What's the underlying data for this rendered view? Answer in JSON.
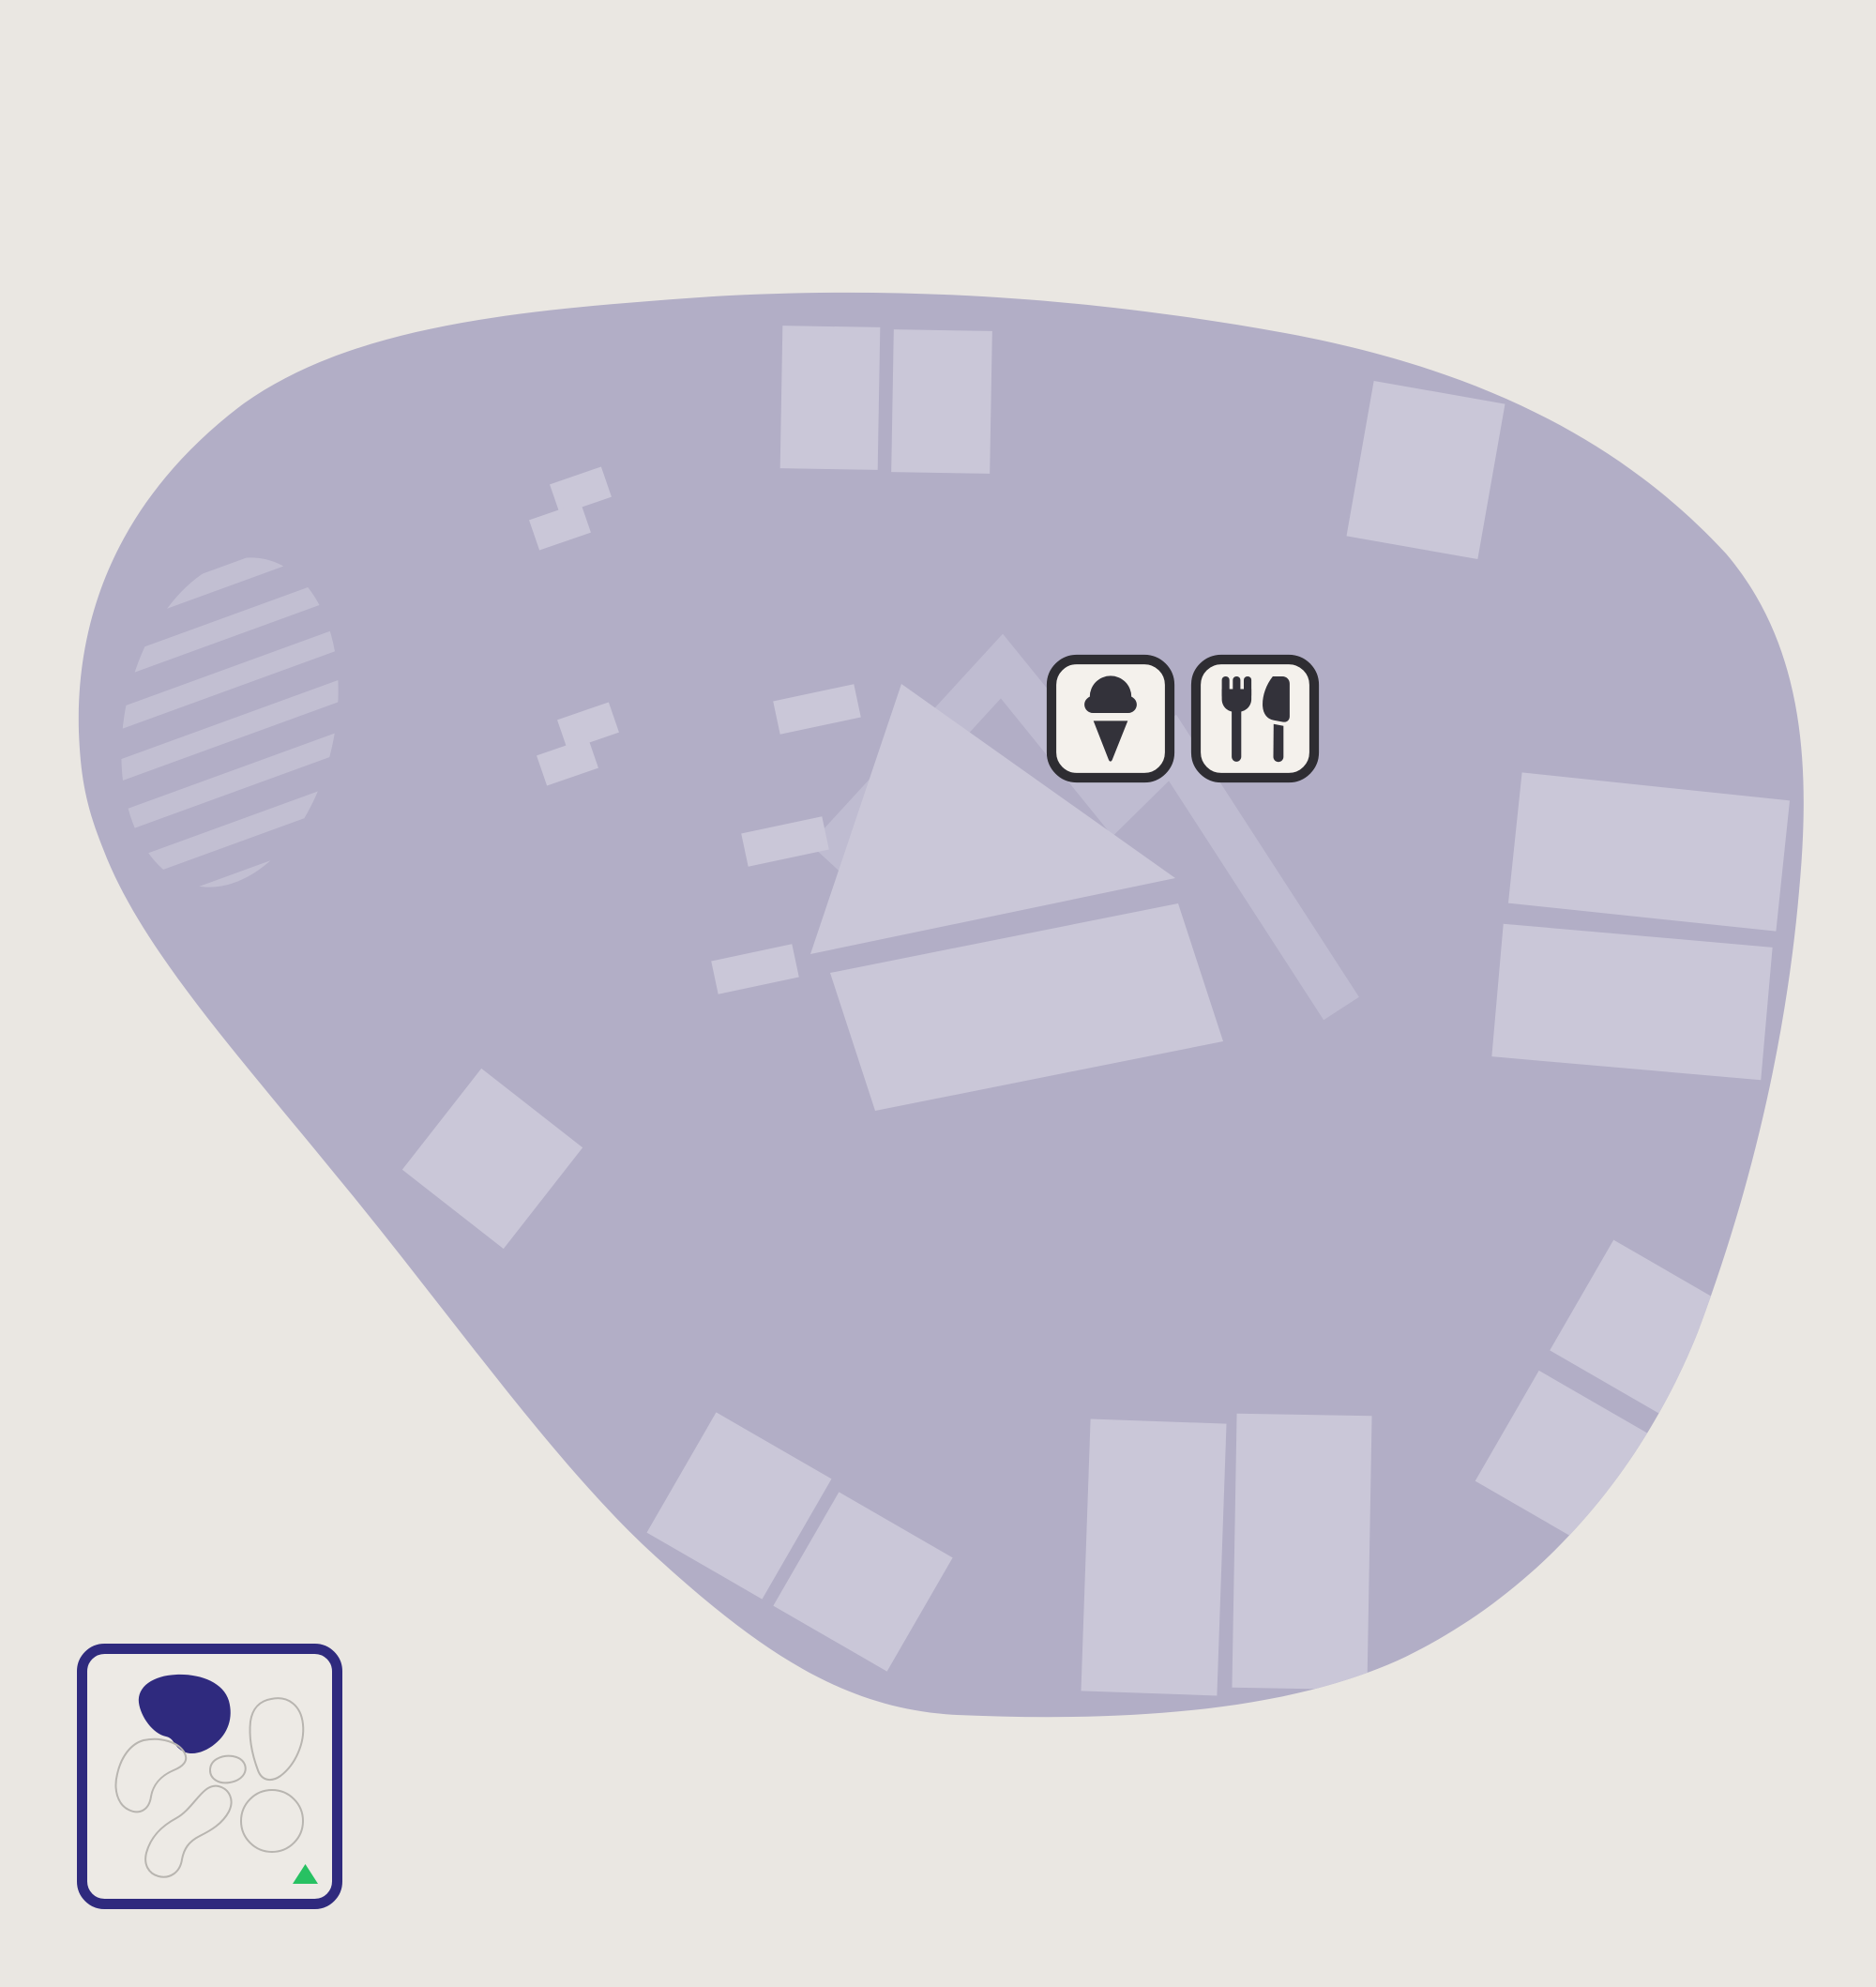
{
  "map": {
    "background": "#eae7e2",
    "area_fill": "#b2aec6",
    "feature_fill": "#cac7d8",
    "hatch_fill": "#c2bfd2",
    "band_fill": "#bfbcd1"
  },
  "poi_buttons": {
    "frame_fill": "#f4f1ec",
    "frame_border": "#2e2d32",
    "icon_color": "#33323a",
    "items": [
      {
        "id": "ice-cream",
        "icon": "ice-cream-icon"
      },
      {
        "id": "restaurant",
        "icon": "utensils-icon"
      }
    ]
  },
  "minimap": {
    "frame_fill": "#edeae5",
    "frame_border": "#2f2a7e",
    "region_outline": "#b8b5b0",
    "active_region_fill": "#2f2a7e",
    "marker_color": "#27c162",
    "regions_total": 6,
    "marker_icon": "triangle-marker-icon"
  }
}
